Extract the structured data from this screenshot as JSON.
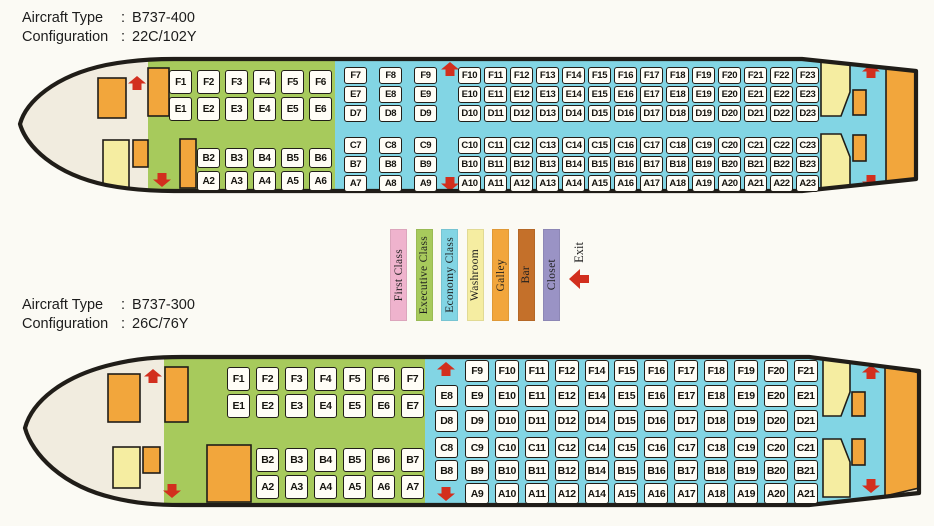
{
  "palette": {
    "first": "#efb3cd",
    "executive": "#a7ca5c",
    "economy": "#82d5e4",
    "washroom": "#f5eda1",
    "galley": "#f2a63c",
    "bar": "#c4702a",
    "closet": "#9a93c5",
    "exit_red": "#d22f1e",
    "fuselage": "#f1ecdf",
    "outline": "#201d18"
  },
  "planes": [
    {
      "type_label": "Aircraft Type",
      "type_value": "B737-400",
      "config_label": "Configuration",
      "config_value": "22C/102Y",
      "separator": ":",
      "exec_upper": [
        [
          "F1",
          "E1"
        ],
        [
          "F2",
          "E2"
        ],
        [
          "F3",
          "E3"
        ],
        [
          "F4",
          "E4"
        ],
        [
          "F5",
          "E5"
        ],
        [
          "F6",
          "E6"
        ]
      ],
      "exec_lower": [
        [
          "B2",
          "A2"
        ],
        [
          "B3",
          "A3"
        ],
        [
          "B4",
          "A4"
        ],
        [
          "B5",
          "A5"
        ],
        [
          "B6",
          "A6"
        ]
      ],
      "econ_upper_a": [
        [
          "F7",
          "E7",
          "D7"
        ],
        [
          "F8",
          "E8",
          "D8"
        ],
        [
          "F9",
          "E9",
          "D9"
        ]
      ],
      "econ_lower_a": [
        [
          "C7",
          "B7",
          "A7"
        ],
        [
          "C8",
          "B8",
          "A8"
        ],
        [
          "C9",
          "B9",
          "A9"
        ]
      ],
      "econ_upper_b": [
        [
          "F10",
          "E10",
          "D10"
        ],
        [
          "F11",
          "E11",
          "D11"
        ],
        [
          "F12",
          "E12",
          "D12"
        ],
        [
          "F13",
          "E13",
          "D13"
        ],
        [
          "F14",
          "E14",
          "D14"
        ],
        [
          "F15",
          "E15",
          "D15"
        ],
        [
          "F16",
          "E16",
          "D16"
        ],
        [
          "F17",
          "E17",
          "D17"
        ],
        [
          "F18",
          "E18",
          "D18"
        ],
        [
          "F19",
          "E19",
          "D19"
        ],
        [
          "F20",
          "E20",
          "D20"
        ],
        [
          "F21",
          "E21",
          "D21"
        ],
        [
          "F22",
          "E22",
          "D22"
        ],
        [
          "F23",
          "E23",
          "D23"
        ]
      ],
      "econ_lower_b": [
        [
          "C10",
          "B10",
          "A10"
        ],
        [
          "C11",
          "B11",
          "A11"
        ],
        [
          "C12",
          "B12",
          "A12"
        ],
        [
          "C13",
          "B13",
          "A13"
        ],
        [
          "C14",
          "B14",
          "A14"
        ],
        [
          "C15",
          "B15",
          "A15"
        ],
        [
          "C16",
          "B16",
          "A16"
        ],
        [
          "C17",
          "B17",
          "A17"
        ],
        [
          "C18",
          "B18",
          "A18"
        ],
        [
          "C19",
          "B19",
          "A19"
        ],
        [
          "C20",
          "B20",
          "A20"
        ],
        [
          "C21",
          "B21",
          "A21"
        ],
        [
          "C22",
          "B22",
          "A22"
        ],
        [
          "C23",
          "B23",
          "A23"
        ]
      ]
    },
    {
      "type_label": "Aircraft Type",
      "type_value": "B737-300",
      "config_label": "Configuration",
      "config_value": "26C/76Y",
      "separator": ":",
      "exec_upper": [
        [
          "F1",
          "E1"
        ],
        [
          "F2",
          "E2"
        ],
        [
          "F3",
          "E3"
        ],
        [
          "F4",
          "E4"
        ],
        [
          "F5",
          "E5"
        ],
        [
          "F6",
          "E6"
        ],
        [
          "F7",
          "E7"
        ]
      ],
      "exec_lower": [
        [
          "B2",
          "A2"
        ],
        [
          "B3",
          "A3"
        ],
        [
          "B4",
          "A4"
        ],
        [
          "B5",
          "A5"
        ],
        [
          "B6",
          "A6"
        ],
        [
          "B7",
          "A7"
        ]
      ],
      "econ_upper_a": [
        [
          null,
          "E8",
          "D8"
        ]
      ],
      "econ_lower_a": [
        [
          "C8",
          "B8",
          null
        ]
      ],
      "econ_upper_b": [
        [
          "F9",
          "E9",
          "D9"
        ],
        [
          "F10",
          "E10",
          "D10"
        ],
        [
          "F11",
          "E11",
          "D11"
        ],
        [
          "F12",
          "E12",
          "D12"
        ],
        [
          "F14",
          "E14",
          "D14"
        ],
        [
          "F15",
          "E15",
          "D15"
        ],
        [
          "F16",
          "E16",
          "D16"
        ],
        [
          "F17",
          "E17",
          "D17"
        ],
        [
          "F18",
          "E18",
          "D18"
        ],
        [
          "F19",
          "E19",
          "D19"
        ],
        [
          "F20",
          "E20",
          "D20"
        ],
        [
          "F21",
          "E21",
          "D21"
        ]
      ],
      "econ_lower_b": [
        [
          "C9",
          "B9",
          "A9"
        ],
        [
          "C10",
          "B10",
          "A10"
        ],
        [
          "C11",
          "B11",
          "A11"
        ],
        [
          "C12",
          "B12",
          "A12"
        ],
        [
          "C14",
          "B14",
          "A14"
        ],
        [
          "C15",
          "B15",
          "A15"
        ],
        [
          "C16",
          "B16",
          "A16"
        ],
        [
          "C17",
          "B17",
          "A17"
        ],
        [
          "C18",
          "B18",
          "A18"
        ],
        [
          "C19",
          "B19",
          "A19"
        ],
        [
          "C20",
          "B20",
          "A20"
        ],
        [
          "C21",
          "B21",
          "A21"
        ]
      ]
    }
  ],
  "legend": {
    "items": [
      {
        "label": "First Class",
        "color": "#efb3cd"
      },
      {
        "label": "Executive Class",
        "color": "#a7ca5c"
      },
      {
        "label": "Economy Class",
        "color": "#82d5e4"
      },
      {
        "label": "Washroom",
        "color": "#f5eda1"
      },
      {
        "label": "Galley",
        "color": "#f2a63c"
      },
      {
        "label": "Bar",
        "color": "#c4702a"
      },
      {
        "label": "Closet",
        "color": "#9a93c5"
      }
    ],
    "exit_label": "Exit"
  }
}
